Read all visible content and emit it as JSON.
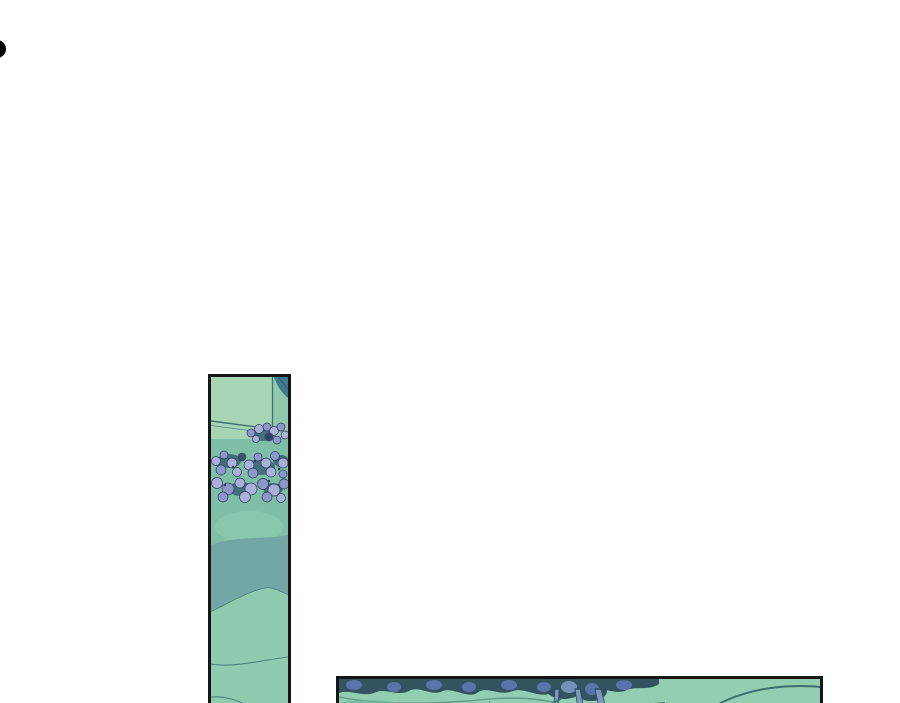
{
  "page": {
    "background": "#ffffff"
  },
  "decor": {
    "partial_glyph": {
      "icon": "partial-circle-glyph",
      "color": "#000000"
    }
  },
  "comic": {
    "panels": {
      "tall": {
        "name": "tall-comic-panel"
      },
      "wide": {
        "name": "wide-comic-panel"
      }
    }
  },
  "colors": {
    "page-bg": "#ffffff",
    "ink": "#161616",
    "glyph-black": "#000000",
    "g-light": "#a6d4b5",
    "g-mid": "#7fbfa7",
    "g-soft": "#8ecbb0",
    "g-wide": "#93ceb2",
    "g-dark-wash": "#72b69c",
    "teal-wash": "#73a7a5",
    "teal-dark": "#3e7a8d",
    "line-teal": "#3d6f6f",
    "line-soft": "#4a8580",
    "flower-light": "#aab1d9",
    "flower-mid": "#8d97c9",
    "flower-navy": "#2e3a5e",
    "foliage-dark": "#33545e",
    "foliage-green": "#42707c",
    "trunk-blue": "#7e98c2",
    "trunk-outline": "#2c4a66",
    "leaf-blue": "#5e78b4"
  }
}
